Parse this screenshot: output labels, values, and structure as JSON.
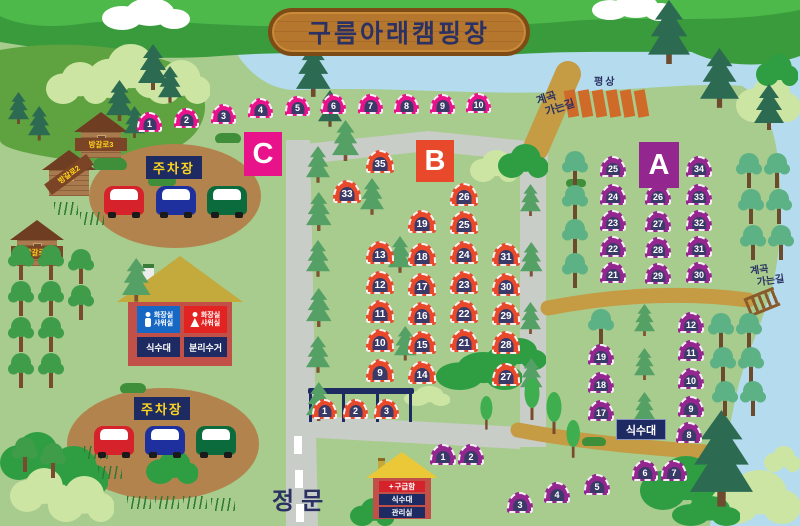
{
  "title": "구름아래캠핑장",
  "labels": {
    "gate": "정문",
    "parking": "주차장",
    "platform": "평상",
    "valley_line1": "계곡",
    "valley_line2": "가는길",
    "water": "식수대",
    "recycle": "분리수거",
    "toilet_line1": "화장실",
    "toilet_line2": "샤워실",
    "firstaid": "구급함",
    "office": "관리실",
    "cross": "+"
  },
  "colors": {
    "grass": "#a8cb8e",
    "river": "#b4dcee",
    "road": "#c9cdc8",
    "path_tan": "#c59b43",
    "sign_navy": "#1e2b63",
    "sign_yellow": "#ffd61e",
    "section_a": "#94278f",
    "section_b": "#e8492a",
    "section_c": "#e8138b",
    "tent_door": "#3a3a68"
  },
  "sections": [
    {
      "id": "C",
      "label": "C",
      "color": "#e8138b",
      "tent_w": 25,
      "tent_h": 20,
      "tents": [
        {
          "n": 1,
          "x": 137,
          "y": 112
        },
        {
          "n": 2,
          "x": 174,
          "y": 108
        },
        {
          "n": 3,
          "x": 211,
          "y": 104
        },
        {
          "n": 4,
          "x": 248,
          "y": 98
        },
        {
          "n": 5,
          "x": 285,
          "y": 96
        },
        {
          "n": 6,
          "x": 321,
          "y": 94
        },
        {
          "n": 7,
          "x": 358,
          "y": 94
        },
        {
          "n": 8,
          "x": 394,
          "y": 94
        },
        {
          "n": 9,
          "x": 430,
          "y": 94
        },
        {
          "n": 10,
          "x": 466,
          "y": 93
        }
      ]
    },
    {
      "id": "B",
      "label": "B",
      "color": "#e8492a",
      "tent_w": 28,
      "tent_h": 23,
      "tents": [
        {
          "n": 35,
          "x": 366,
          "y": 150
        },
        {
          "n": 33,
          "x": 333,
          "y": 180
        },
        {
          "n": 26,
          "x": 450,
          "y": 183
        },
        {
          "n": 19,
          "x": 408,
          "y": 210
        },
        {
          "n": 25,
          "x": 450,
          "y": 211
        },
        {
          "n": 13,
          "x": 366,
          "y": 241
        },
        {
          "n": 18,
          "x": 408,
          "y": 243
        },
        {
          "n": 24,
          "x": 450,
          "y": 241
        },
        {
          "n": 31,
          "x": 492,
          "y": 243
        },
        {
          "n": 12,
          "x": 366,
          "y": 271
        },
        {
          "n": 17,
          "x": 408,
          "y": 273
        },
        {
          "n": 23,
          "x": 450,
          "y": 271
        },
        {
          "n": 30,
          "x": 492,
          "y": 273
        },
        {
          "n": 11,
          "x": 366,
          "y": 300
        },
        {
          "n": 16,
          "x": 408,
          "y": 302
        },
        {
          "n": 22,
          "x": 450,
          "y": 300
        },
        {
          "n": 29,
          "x": 492,
          "y": 302
        },
        {
          "n": 10,
          "x": 366,
          "y": 329
        },
        {
          "n": 15,
          "x": 408,
          "y": 331
        },
        {
          "n": 21,
          "x": 450,
          "y": 329
        },
        {
          "n": 28,
          "x": 492,
          "y": 331
        },
        {
          "n": 9,
          "x": 366,
          "y": 359
        },
        {
          "n": 14,
          "x": 408,
          "y": 361
        },
        {
          "n": 27,
          "x": 492,
          "y": 363
        },
        {
          "n": 1,
          "x": 312,
          "y": 399,
          "w": 25,
          "h": 20
        },
        {
          "n": 2,
          "x": 343,
          "y": 399,
          "w": 25,
          "h": 20
        },
        {
          "n": 3,
          "x": 374,
          "y": 399,
          "w": 25,
          "h": 20
        }
      ]
    },
    {
      "id": "A",
      "label": "A",
      "color": "#94278f",
      "tent_w": 26,
      "tent_h": 21,
      "tents": [
        {
          "n": 25,
          "x": 600,
          "y": 156
        },
        {
          "n": 34,
          "x": 686,
          "y": 156
        },
        {
          "n": 24,
          "x": 600,
          "y": 184
        },
        {
          "n": 26,
          "x": 645,
          "y": 184
        },
        {
          "n": 33,
          "x": 686,
          "y": 184
        },
        {
          "n": 23,
          "x": 600,
          "y": 210
        },
        {
          "n": 27,
          "x": 645,
          "y": 211
        },
        {
          "n": 32,
          "x": 686,
          "y": 210
        },
        {
          "n": 22,
          "x": 600,
          "y": 236
        },
        {
          "n": 28,
          "x": 645,
          "y": 237
        },
        {
          "n": 31,
          "x": 686,
          "y": 236
        },
        {
          "n": 21,
          "x": 600,
          "y": 262
        },
        {
          "n": 29,
          "x": 645,
          "y": 263
        },
        {
          "n": 30,
          "x": 686,
          "y": 262
        },
        {
          "n": 12,
          "x": 678,
          "y": 312
        },
        {
          "n": 11,
          "x": 678,
          "y": 340
        },
        {
          "n": 10,
          "x": 678,
          "y": 368
        },
        {
          "n": 9,
          "x": 678,
          "y": 396
        },
        {
          "n": 8,
          "x": 676,
          "y": 422
        },
        {
          "n": 19,
          "x": 588,
          "y": 344
        },
        {
          "n": 18,
          "x": 588,
          "y": 372
        },
        {
          "n": 17,
          "x": 588,
          "y": 400
        },
        {
          "n": 1,
          "x": 430,
          "y": 444
        },
        {
          "n": 2,
          "x": 458,
          "y": 444
        },
        {
          "n": 3,
          "x": 507,
          "y": 492
        },
        {
          "n": 4,
          "x": 544,
          "y": 482
        },
        {
          "n": 5,
          "x": 584,
          "y": 474
        },
        {
          "n": 6,
          "x": 632,
          "y": 460
        },
        {
          "n": 7,
          "x": 661,
          "y": 460
        }
      ]
    }
  ],
  "cabins": [
    {
      "label": "방갈로3",
      "x": 74,
      "y": 112,
      "rot": 0
    },
    {
      "label": "방갈로2",
      "x": 42,
      "y": 150,
      "rot": -36
    },
    {
      "label": "방갈로1",
      "x": 10,
      "y": 220,
      "rot": 0
    }
  ],
  "cars": [
    {
      "x": 104,
      "y": 186,
      "color": "#d6222a"
    },
    {
      "x": 156,
      "y": 186,
      "color": "#1e2f9e"
    },
    {
      "x": 207,
      "y": 186,
      "color": "#0c6b3c"
    },
    {
      "x": 94,
      "y": 426,
      "color": "#d6222a"
    },
    {
      "x": 145,
      "y": 426,
      "color": "#1e2f9e"
    },
    {
      "x": 196,
      "y": 426,
      "color": "#0c6b3c"
    }
  ],
  "platforms": {
    "y": 90,
    "xs": [
      566,
      580,
      594,
      608,
      622,
      636
    ]
  },
  "scenery": [
    {
      "t": "busho",
      "x": 46,
      "y": 62,
      "w": 62,
      "h": 42
    },
    {
      "t": "busho",
      "x": 88,
      "y": 44,
      "w": 78,
      "h": 54
    },
    {
      "t": "busho",
      "x": 146,
      "y": 60,
      "w": 64,
      "h": 44
    },
    {
      "t": "busho",
      "x": 736,
      "y": 76,
      "w": 64,
      "h": 46
    },
    {
      "t": "bushg",
      "x": 756,
      "y": 54,
      "w": 42,
      "h": 32
    },
    {
      "t": "busho",
      "x": 470,
      "y": 150,
      "w": 48,
      "h": 32
    },
    {
      "t": "bushg",
      "x": 498,
      "y": 144,
      "w": 50,
      "h": 34
    },
    {
      "t": "blobd",
      "x": 93,
      "y": 157,
      "w": 34,
      "h": 13
    },
    {
      "t": "blobd",
      "x": 215,
      "y": 133,
      "w": 26,
      "h": 10
    },
    {
      "t": "blobd",
      "x": 148,
      "y": 175,
      "w": 28,
      "h": 11
    },
    {
      "t": "blobd",
      "x": 120,
      "y": 383,
      "w": 26,
      "h": 10
    },
    {
      "t": "blobd",
      "x": 566,
      "y": 179,
      "w": 20,
      "h": 8
    },
    {
      "t": "blobd",
      "x": 582,
      "y": 437,
      "w": 24,
      "h": 9
    },
    {
      "t": "bushg",
      "x": 486,
      "y": 338,
      "w": 60,
      "h": 32
    },
    {
      "t": "bushg",
      "x": 436,
      "y": 352,
      "w": 86,
      "h": 38
    },
    {
      "t": "busho",
      "x": 404,
      "y": 386,
      "w": 46,
      "h": 20
    },
    {
      "t": "bushg",
      "x": 0,
      "y": 432,
      "w": 68,
      "h": 48
    },
    {
      "t": "bushg",
      "x": 32,
      "y": 446,
      "w": 76,
      "h": 50
    },
    {
      "t": "busho",
      "x": 10,
      "y": 468,
      "w": 62,
      "h": 44
    },
    {
      "t": "busho",
      "x": 48,
      "y": 476,
      "w": 66,
      "h": 46
    },
    {
      "t": "bushg",
      "x": 146,
      "y": 450,
      "w": 52,
      "h": 34
    },
    {
      "t": "bushg",
      "x": 350,
      "y": 498,
      "w": 44,
      "h": 28
    },
    {
      "t": "bushg",
      "x": 640,
      "y": 456,
      "w": 84,
      "h": 54
    },
    {
      "t": "busho",
      "x": 710,
      "y": 470,
      "w": 90,
      "h": 54
    },
    {
      "t": "busho",
      "x": 764,
      "y": 446,
      "w": 36,
      "h": 26
    },
    {
      "t": "bushg",
      "x": 672,
      "y": 496,
      "w": 68,
      "h": 30
    },
    {
      "t": "reed",
      "x": 54,
      "y": 202
    },
    {
      "t": "reed",
      "x": 80,
      "y": 212
    },
    {
      "t": "reed",
      "x": 84,
      "y": 446
    },
    {
      "t": "reed",
      "x": 98,
      "y": 466
    },
    {
      "t": "reed",
      "x": 127,
      "y": 496
    },
    {
      "t": "reed",
      "x": 155,
      "y": 496
    },
    {
      "t": "reed",
      "x": 183,
      "y": 496
    },
    {
      "t": "reed",
      "x": 211,
      "y": 498
    },
    {
      "t": "pined",
      "x": 138,
      "y": 44,
      "s": 1
    },
    {
      "t": "pined",
      "x": 158,
      "y": 66,
      "s": 0.8
    },
    {
      "t": "pined",
      "x": 296,
      "y": 44,
      "s": 1.15
    },
    {
      "t": "pined",
      "x": 318,
      "y": 90,
      "s": 0.8
    },
    {
      "t": "pined",
      "x": 8,
      "y": 92,
      "s": 0.7
    },
    {
      "t": "pined",
      "x": 28,
      "y": 106,
      "s": 0.75
    },
    {
      "t": "pined",
      "x": 106,
      "y": 80,
      "s": 0.9
    },
    {
      "t": "pined",
      "x": 124,
      "y": 106,
      "s": 0.7
    },
    {
      "t": "pined",
      "x": 648,
      "y": 0,
      "s": 1.4
    },
    {
      "t": "pined",
      "x": 700,
      "y": 48,
      "s": 1.3
    },
    {
      "t": "pined",
      "x": 754,
      "y": 84,
      "s": 1.0
    },
    {
      "t": "pined",
      "x": 690,
      "y": 410,
      "s": 2.1
    },
    {
      "t": "pinem",
      "x": 306,
      "y": 146,
      "s": 0.8
    },
    {
      "t": "pinem",
      "x": 306,
      "y": 192,
      "s": 0.85
    },
    {
      "t": "pinem",
      "x": 306,
      "y": 240,
      "s": 0.8
    },
    {
      "t": "pinem",
      "x": 306,
      "y": 288,
      "s": 0.85
    },
    {
      "t": "pinem",
      "x": 306,
      "y": 336,
      "s": 0.8
    },
    {
      "t": "pinem",
      "x": 306,
      "y": 382,
      "s": 0.85
    },
    {
      "t": "pinem",
      "x": 332,
      "y": 120,
      "s": 0.9
    },
    {
      "t": "pinem",
      "x": 360,
      "y": 178,
      "s": 0.8
    },
    {
      "t": "pinem",
      "x": 388,
      "y": 236,
      "s": 0.8
    },
    {
      "t": "pinem",
      "x": 394,
      "y": 326,
      "s": 0.75
    },
    {
      "t": "pinem",
      "x": 520,
      "y": 184,
      "s": 0.7
    },
    {
      "t": "pinem",
      "x": 520,
      "y": 242,
      "s": 0.75
    },
    {
      "t": "pinem",
      "x": 520,
      "y": 302,
      "s": 0.7
    },
    {
      "t": "pinem",
      "x": 520,
      "y": 358,
      "s": 0.75
    },
    {
      "t": "pinem",
      "x": 634,
      "y": 304,
      "s": 0.7
    },
    {
      "t": "pinem",
      "x": 634,
      "y": 348,
      "s": 0.7
    },
    {
      "t": "pinem",
      "x": 634,
      "y": 392,
      "s": 0.7
    },
    {
      "t": "pinem",
      "x": 122,
      "y": 258,
      "s": 0.95
    },
    {
      "t": "tree",
      "x": 8,
      "y": 244
    },
    {
      "t": "tree",
      "x": 38,
      "y": 244
    },
    {
      "t": "tree",
      "x": 68,
      "y": 248
    },
    {
      "t": "tree",
      "x": 8,
      "y": 280
    },
    {
      "t": "tree",
      "x": 38,
      "y": 280
    },
    {
      "t": "tree",
      "x": 68,
      "y": 284
    },
    {
      "t": "tree",
      "x": 8,
      "y": 316
    },
    {
      "t": "tree",
      "x": 38,
      "y": 316
    },
    {
      "t": "tree",
      "x": 8,
      "y": 352
    },
    {
      "t": "tree",
      "x": 38,
      "y": 352
    },
    {
      "t": "tree",
      "x": 12,
      "y": 436
    },
    {
      "t": "tree",
      "x": 40,
      "y": 442
    },
    {
      "t": "tree2",
      "x": 562,
      "y": 150
    },
    {
      "t": "tree2",
      "x": 562,
      "y": 184
    },
    {
      "t": "tree2",
      "x": 562,
      "y": 218
    },
    {
      "t": "tree2",
      "x": 562,
      "y": 252
    },
    {
      "t": "tree2",
      "x": 588,
      "y": 308
    },
    {
      "t": "tree2",
      "x": 708,
      "y": 312
    },
    {
      "t": "tree2",
      "x": 736,
      "y": 312
    },
    {
      "t": "tree2",
      "x": 710,
      "y": 346
    },
    {
      "t": "tree2",
      "x": 738,
      "y": 346
    },
    {
      "t": "tree2",
      "x": 712,
      "y": 380
    },
    {
      "t": "tree2",
      "x": 740,
      "y": 380
    },
    {
      "t": "tree2",
      "x": 736,
      "y": 152
    },
    {
      "t": "tree2",
      "x": 764,
      "y": 152
    },
    {
      "t": "tree2",
      "x": 738,
      "y": 188
    },
    {
      "t": "tree2",
      "x": 766,
      "y": 188
    },
    {
      "t": "tree2",
      "x": 740,
      "y": 224
    },
    {
      "t": "tree2",
      "x": 768,
      "y": 224
    },
    {
      "t": "pop",
      "x": 524,
      "y": 378,
      "s": 1
    },
    {
      "t": "pop",
      "x": 546,
      "y": 392,
      "s": 1
    },
    {
      "t": "pop",
      "x": 480,
      "y": 396,
      "s": 0.8
    },
    {
      "t": "pop",
      "x": 566,
      "y": 420,
      "s": 0.9
    }
  ]
}
